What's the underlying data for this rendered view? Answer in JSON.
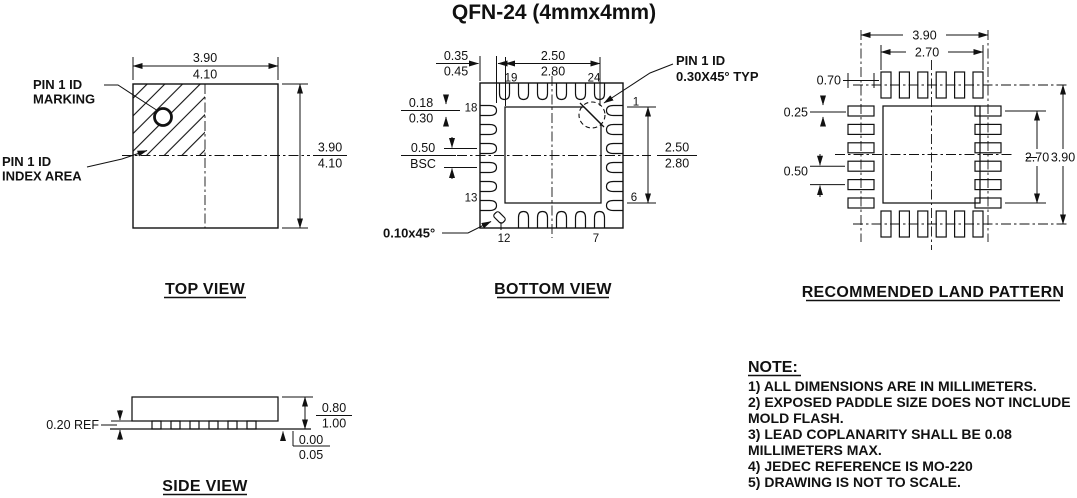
{
  "title": "QFN-24 (4mmx4mm)",
  "top_view": {
    "caption": "TOP VIEW",
    "marking_label_l1": "PIN 1 ID",
    "marking_label_l2": "MARKING",
    "index_label_l1": "PIN 1 ID",
    "index_label_l2": "INDEX AREA",
    "width_dim_nom": "3.90",
    "width_dim_max": "4.10",
    "height_dim_nom": "3.90",
    "height_dim_max": "4.10"
  },
  "bottom_view": {
    "caption": "BOTTOM VIEW",
    "lead_len_nom": "0.35",
    "lead_len_max": "0.45",
    "epad_w_nom": "2.50",
    "epad_w_max": "2.80",
    "lead_w_nom": "0.18",
    "lead_w_max": "0.30",
    "pitch_val": "0.50",
    "pitch_ref": "BSC",
    "epad_h_nom": "2.50",
    "epad_h_max": "2.80",
    "chamfer_label": "0.10x45°",
    "pin1_label_l1": "PIN 1 ID",
    "pin1_label_l2": "0.30X45° TYP",
    "pin_19": "19",
    "pin_24": "24",
    "pin_18": "18",
    "pin_13": "13",
    "pin_12": "12",
    "pin_7": "7",
    "pin_1": "1",
    "pin_6": "6"
  },
  "land_pattern": {
    "caption": "RECOMMENDED LAND PATTERN",
    "outer_width": "3.90",
    "inner_width": "2.70",
    "pad_length": "0.70",
    "pad_width": "0.25",
    "pitch": "0.50",
    "inner_height": "2.70",
    "outer_height": "3.90"
  },
  "side_view": {
    "caption": "SIDE VIEW",
    "standoff": "0.20 REF",
    "height_nom": "0.80",
    "height_max": "1.00",
    "seat_min": "0.00",
    "seat_max": "0.05"
  },
  "notes": {
    "heading": "NOTE:",
    "lines": [
      "1) ALL DIMENSIONS ARE IN MILLIMETERS.",
      "2) EXPOSED PADDLE SIZE DOES NOT INCLUDE",
      "MOLD FLASH.",
      "3) LEAD COPLANARITY SHALL BE 0.08",
      "MILLIMETERS MAX.",
      "4) JEDEC REFERENCE IS MO-220",
      "5) DRAWING IS NOT TO SCALE."
    ]
  }
}
